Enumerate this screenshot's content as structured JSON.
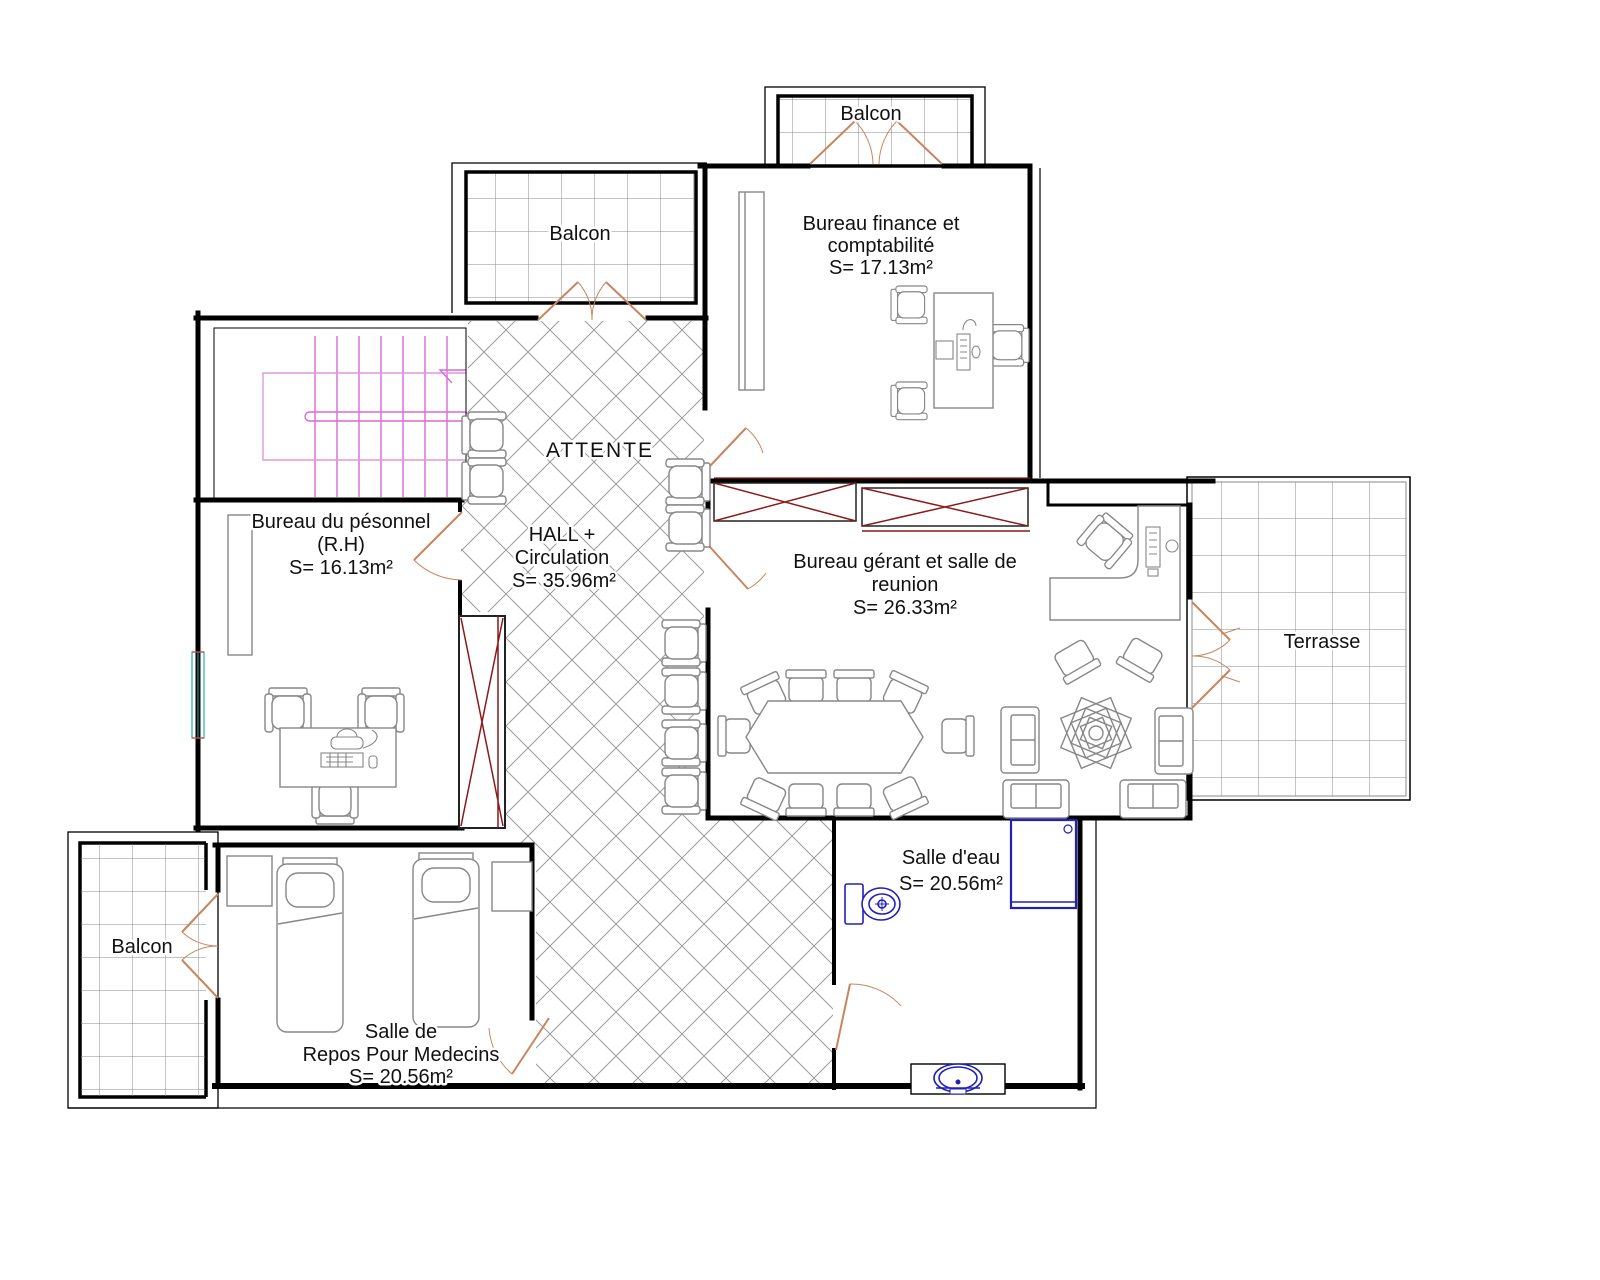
{
  "drawing_type": "architectural floor plan",
  "rooms": {
    "balcon_top": {
      "label": "Balcon"
    },
    "bureau_finance": {
      "lines": [
        "Bureau finance et",
        "comptabilité",
        "S= 17.13m²"
      ]
    },
    "balcon_upper_left": {
      "label": "Balcon"
    },
    "attente": {
      "label": "ATTENTE"
    },
    "hall": {
      "lines": [
        "HALL +",
        "Circulation",
        "S= 35.96m²"
      ]
    },
    "bureau_rh": {
      "lines": [
        "Bureau du pésonnel",
        "(R.H)",
        "S= 16.13m²"
      ]
    },
    "bureau_gerant": {
      "lines": [
        "Bureau gérant et salle de",
        "reunion",
        "S= 26.33m²"
      ]
    },
    "terrasse": {
      "label": "Terrasse"
    },
    "salle_eau": {
      "lines": [
        "Salle d'eau",
        "S= 20.56m²"
      ]
    },
    "salle_repos": {
      "lines": [
        "Salle de",
        "Repos Pour Medecins",
        "S= 20.56m²"
      ]
    },
    "balcon_bottom": {
      "label": "Balcon"
    }
  },
  "colors": {
    "wall": "#000000",
    "door": "#c9855f",
    "stairs": "#d96ad9",
    "cabinet_x": "#8b1a1a",
    "sanitary": "#2020bb",
    "window": "#20b2aa",
    "furniture": "#878787",
    "tile": "#8a8a8a",
    "hatch": "#9b9b9b"
  }
}
